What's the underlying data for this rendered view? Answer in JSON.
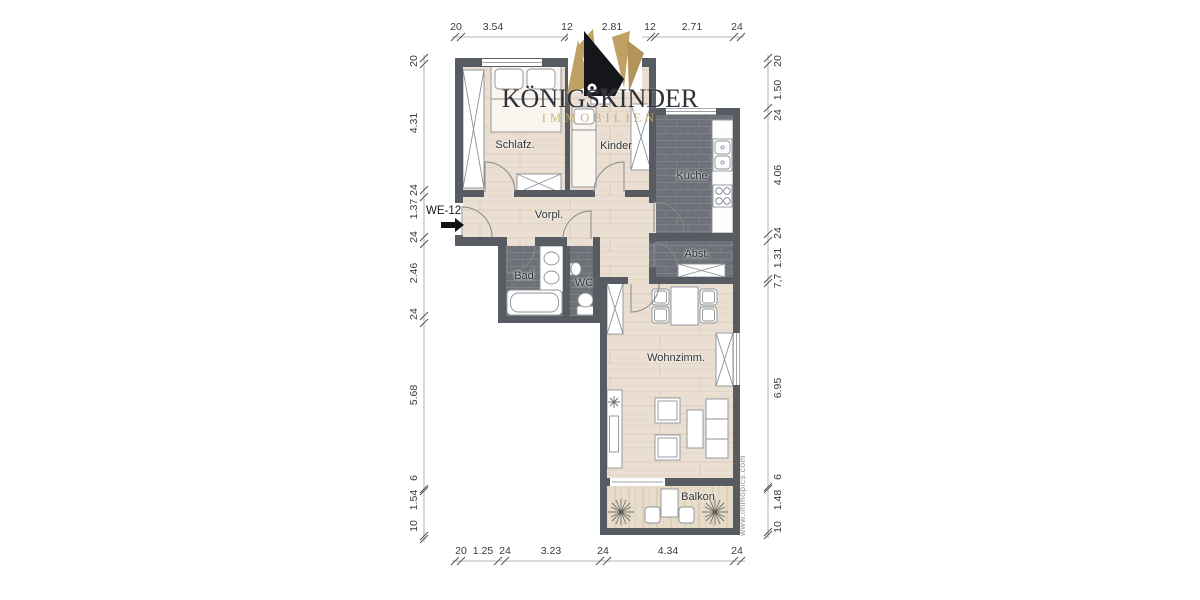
{
  "brand": {
    "name": "KÖNIGSKINDER",
    "tagline": "IMMOBILIEN"
  },
  "unit": {
    "label": "WE-12"
  },
  "watermark": {
    "text": "www.immopics.com"
  },
  "rooms": {
    "schlafzimmer": "Schlafz.",
    "kinderzimmer": "Kinder",
    "kueche": "Küche",
    "vorplatz": "Vorpl.",
    "bad": "Bad",
    "wc": "WC",
    "abstellraum": "Abst.",
    "wohnzimmer": "Wohnzimm.",
    "balkon": "Balkon"
  },
  "dimensions": {
    "top": [
      "20",
      "3.54",
      "12",
      "2.81",
      "12",
      "2.71",
      "24"
    ],
    "bottom": [
      "20",
      "1.25",
      "24",
      "3.23",
      "24",
      "4.34",
      "24"
    ],
    "left": [
      "20",
      "4.31",
      "24",
      "1.37",
      "24",
      "2.46",
      "24",
      "5.68",
      "6",
      "1.54",
      "10"
    ],
    "right": [
      "20",
      "1.50",
      "24",
      "4.06",
      "24",
      "1.31",
      "7,7",
      "6.95",
      "6",
      "1.48",
      "10"
    ]
  },
  "colors": {
    "wall": "#575c63",
    "wood_floor": "#eadfd2",
    "tile_floor": "#6e7278",
    "crown_gold": "#c0a163",
    "crown_black": "#15161a",
    "brand_text": "#2f3038",
    "tagline_gold": "#c7a76b"
  }
}
